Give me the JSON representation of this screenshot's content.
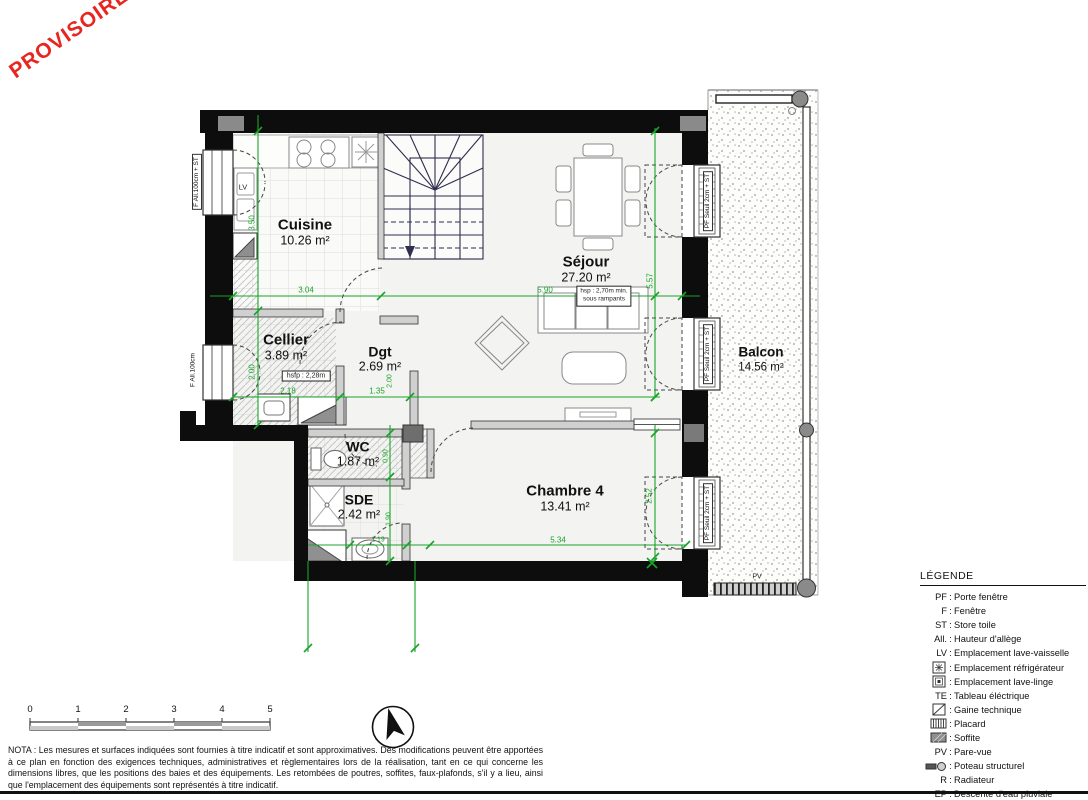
{
  "watermark": {
    "text": "PROVISOIRE",
    "color": "#e8251f"
  },
  "plan": {
    "rooms": [
      {
        "id": "cuisine",
        "name": "Cuisine",
        "area": "10.26 m²"
      },
      {
        "id": "sejour",
        "name": "Séjour",
        "area": "27.20 m²"
      },
      {
        "id": "cellier",
        "name": "Cellier",
        "area": "3.89 m²"
      },
      {
        "id": "dgt",
        "name": "Dgt",
        "area": "2.69 m²"
      },
      {
        "id": "wc",
        "name": "WC",
        "area": "1.87 m²"
      },
      {
        "id": "sde",
        "name": "SDE",
        "area": "2.42 m²"
      },
      {
        "id": "chambre4",
        "name": "Chambre 4",
        "area": "13.41 m²"
      },
      {
        "id": "balcon",
        "name": "Balcon",
        "area": "14.56 m²"
      }
    ],
    "dims": {
      "cuisine_w": "3.04",
      "cuisine_h": "3.50",
      "sejour_w": "5.90",
      "sejour_h": "5.57",
      "cellier_h": "2.00",
      "cellier_w": "2.18",
      "dgt_w": "1.35",
      "dgt_h": "2.00",
      "wc_h": "0.90",
      "sde_h": "1.90",
      "sde_w": "1.19",
      "chambre_w": "5.34",
      "chambre_h": "2.52"
    },
    "annotations": {
      "hsp_line1": "hsp : 2,70m min.",
      "hsp_line2": "sous rampants",
      "hsfp": "hsfp : 2,28m",
      "lv": "LV",
      "pv": "PV"
    },
    "windows": {
      "left_top": "F All.100cm + ST",
      "left_bottom": "F All.100cm",
      "right_top": "PF Seuil 2cm + ST",
      "right_mid": "PF Seuil 2cm + ST",
      "right_bottom": "PF Seuil 2cm + ST"
    },
    "dim_color": "#18a428"
  },
  "legend": {
    "title": "LÉGENDE",
    "sep": ":",
    "items": [
      {
        "key": "PF",
        "label": "Porte fenêtre",
        "icon": null
      },
      {
        "key": "F",
        "label": "Fenêtre",
        "icon": null
      },
      {
        "key": "ST",
        "label": "Store toile",
        "icon": null
      },
      {
        "key": "All.",
        "label": "Hauteur d'allège",
        "icon": null
      },
      {
        "key": "LV",
        "label": "Emplacement lave-vaisselle",
        "icon": null
      },
      {
        "key": "",
        "label": "Emplacement réfrigérateur",
        "icon": "fridge-icon"
      },
      {
        "key": "",
        "label": "Emplacement lave-linge",
        "icon": "washer-icon"
      },
      {
        "key": "TE",
        "label": "Tableau éléctrique",
        "icon": null
      },
      {
        "key": "",
        "label": "Gaine technique",
        "icon": "gaine-icon"
      },
      {
        "key": "",
        "label": "Placard",
        "icon": "placard-icon"
      },
      {
        "key": "",
        "label": "Soffite",
        "icon": "soffite-icon"
      },
      {
        "key": "PV",
        "label": "Pare-vue",
        "icon": null
      },
      {
        "key": "",
        "label": "Poteau structurel",
        "icon": "poteau-icon"
      },
      {
        "key": "R",
        "label": "Radiateur",
        "icon": null
      },
      {
        "key": "EP",
        "label": "Descente d'eau pluviale",
        "icon": null
      }
    ]
  },
  "scalebar": {
    "ticks": [
      "0",
      "1",
      "2",
      "3",
      "4",
      "5"
    ]
  },
  "nota": "NOTA : Les mesures et surfaces indiquées sont fournies à titre indicatif et sont approximatives. Des modifications peuvent être apportées à ce plan en fonction des exigences techniques, administratives et règlementaires lors de la réalisation, tant en ce qui concerne les dimensions libres, que les positions des baies et des équipements. Les retombées de poutres, soffites, faux-plafonds, s'il y a lieu, ainsi que l'emplacement des équipements sont représentés à titre indicatif."
}
